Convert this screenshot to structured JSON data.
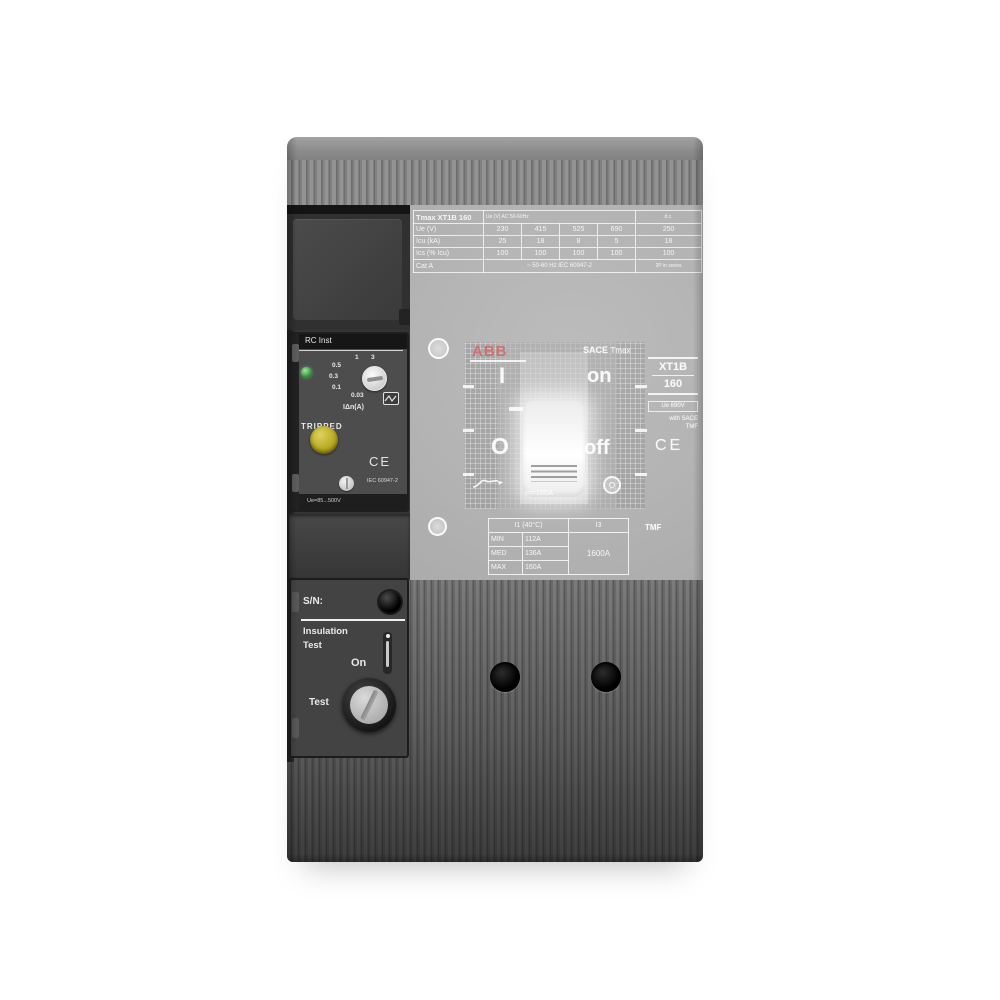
{
  "nameplate": {
    "title": "Tmax XT1B 160",
    "header_note": "Ue (V) AC 50-60Hz",
    "dc_header": "d.c.",
    "rows": [
      {
        "label": "Ue (V)",
        "values": [
          "230",
          "415",
          "525",
          "690"
        ],
        "last": "250"
      },
      {
        "label": "Icu (kA)",
        "values": [
          "25",
          "18",
          "8",
          "5"
        ],
        "last": "18"
      },
      {
        "label": "Ics (% Icu)",
        "values": [
          "100",
          "100",
          "100",
          "100"
        ],
        "last": "100"
      }
    ],
    "footer": {
      "label": "Cat A",
      "mid": "~ 50-60 Hz  IEC 60947-2",
      "last": "2P in series"
    }
  },
  "rc_module": {
    "label": "RC Inst",
    "dial_values": [
      "1",
      "3",
      "0.5",
      "0.3",
      "0.1",
      "0.03"
    ],
    "dial_unit": "IΔn(A)",
    "tripped": "TRIPPED",
    "ce": "CE",
    "iec": "IEC 60947-2",
    "ue": "Ue=85...500V"
  },
  "face": {
    "brand": "ABB",
    "series": "SACE",
    "series_sub": "Tmax",
    "pos_i": "I",
    "pos_on": "on",
    "pos_o": "O",
    "pos_off": "off",
    "model": "XT1B",
    "rating": "160",
    "ue": "Ue 690V",
    "note1": "with SACE",
    "note2": "TMF",
    "ce": "CE",
    "in_rating": "In=160A"
  },
  "strip": {
    "header_i1": "I1 (40°C)",
    "header_i3": "I3",
    "rows": [
      [
        "MIN",
        "112A"
      ],
      [
        "MED",
        "136A"
      ],
      [
        "MAX",
        "160A"
      ]
    ],
    "i3_value": "1600A",
    "type": "TMF"
  },
  "insulation": {
    "sn": "S/N:",
    "line1": "Insulation",
    "line2": "Test",
    "on": "On",
    "test": "Test"
  },
  "colors": {
    "brand_red": "#c06060",
    "led_green": "#4f9f4f",
    "tripped_yellow": "#b5a71f",
    "housing_dark": "#3a3a3a",
    "housing_light": "#8b8b8b",
    "wash": "#b6b6b6"
  }
}
